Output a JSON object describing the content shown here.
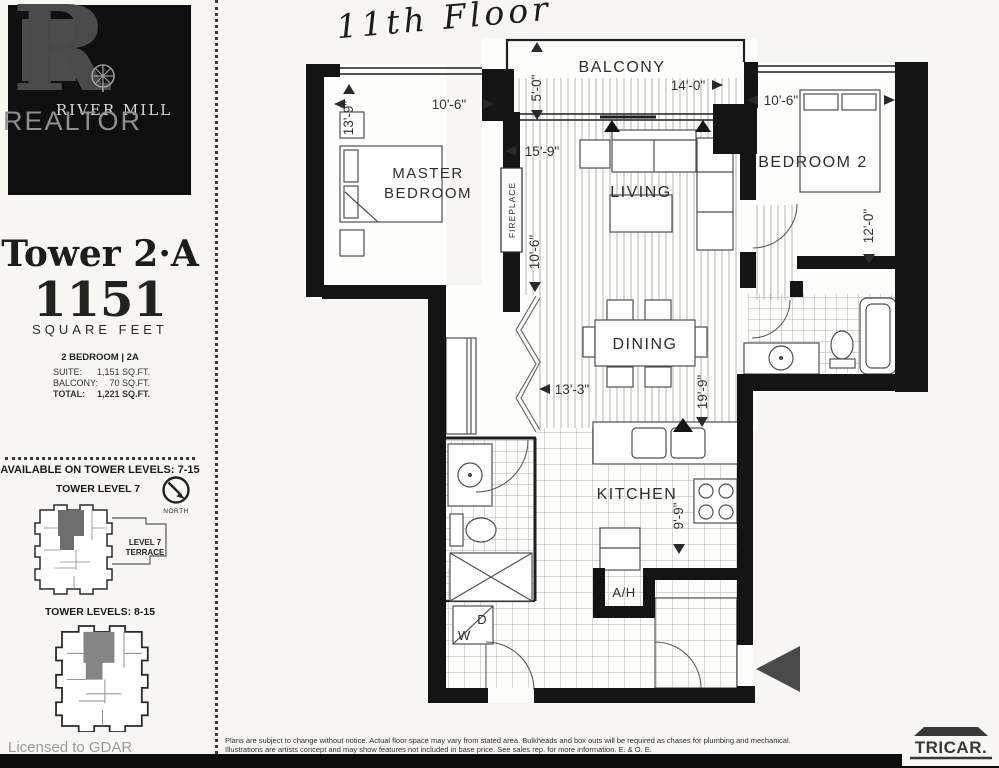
{
  "sidebar": {
    "logo": {
      "watermark_letter": "R",
      "brand": "RIVER MILL",
      "overlay": "REALTOR"
    },
    "tower_title": "Tower 2·A",
    "area_value": "1151",
    "area_label": "SQUARE FEET",
    "unit_type": "2 BEDROOM | 2A",
    "stats": [
      {
        "label": "SUITE:",
        "value": "1,151 SQ.FT."
      },
      {
        "label": "BALCONY:",
        "value": "70 SQ.FT."
      },
      {
        "label": "TOTAL:",
        "value": "1,221 SQ.FT."
      }
    ],
    "availability_heading": "AVAILABLE ON TOWER LEVELS: 7-15",
    "level7_heading": "TOWER LEVEL 7",
    "north_label": "NORTH",
    "terrace_line1": "LEVEL 7",
    "terrace_line2": "TERRACE",
    "levels_heading": "TOWER LEVELS: 8-15",
    "licensed_note": "Licensed to GDAR"
  },
  "plan": {
    "handwritten_note": "11th Floor",
    "rooms": {
      "balcony": "BALCONY",
      "master_line1": "MASTER",
      "master_line2": "BEDROOM",
      "living": "LIVING",
      "bedroom2": "BEDROOM 2",
      "dining": "DINING",
      "kitchen": "KITCHEN",
      "fireplace": "FIREPLACE",
      "air_handler": "A/H",
      "washer": "W",
      "dryer": "D"
    },
    "dimensions": {
      "master_width": "10'-6\"",
      "master_depth": "13'-9\"",
      "balcony_width": "14'-0\"",
      "balcony_depth": "5'-0\"",
      "living_width": "15'-9\"",
      "living_depth": "10'-6\"",
      "bedroom2_width": "10'-6\"",
      "bedroom2_depth": "12'-0\"",
      "dining_width": "13'-3\"",
      "dining_depth": "19'-9\"",
      "kitchen_depth": "9'-9\""
    }
  },
  "footer": {
    "disclaimer_line1": "Plans are subject to change without notice.  Actual floor space may vary from stated area. Bulkheads and box outs will be required as chases for plumbing and mechanical.",
    "disclaimer_line2": "Illustrations are artists concept and may show features not included in base price. See sales rep. for more information. E. & O. E.",
    "builder_logo": "TRICAR."
  },
  "colors": {
    "wall": "#141414",
    "entry_arrow": "#4a4a4a",
    "unit_highlight": "#6e6e6e"
  }
}
